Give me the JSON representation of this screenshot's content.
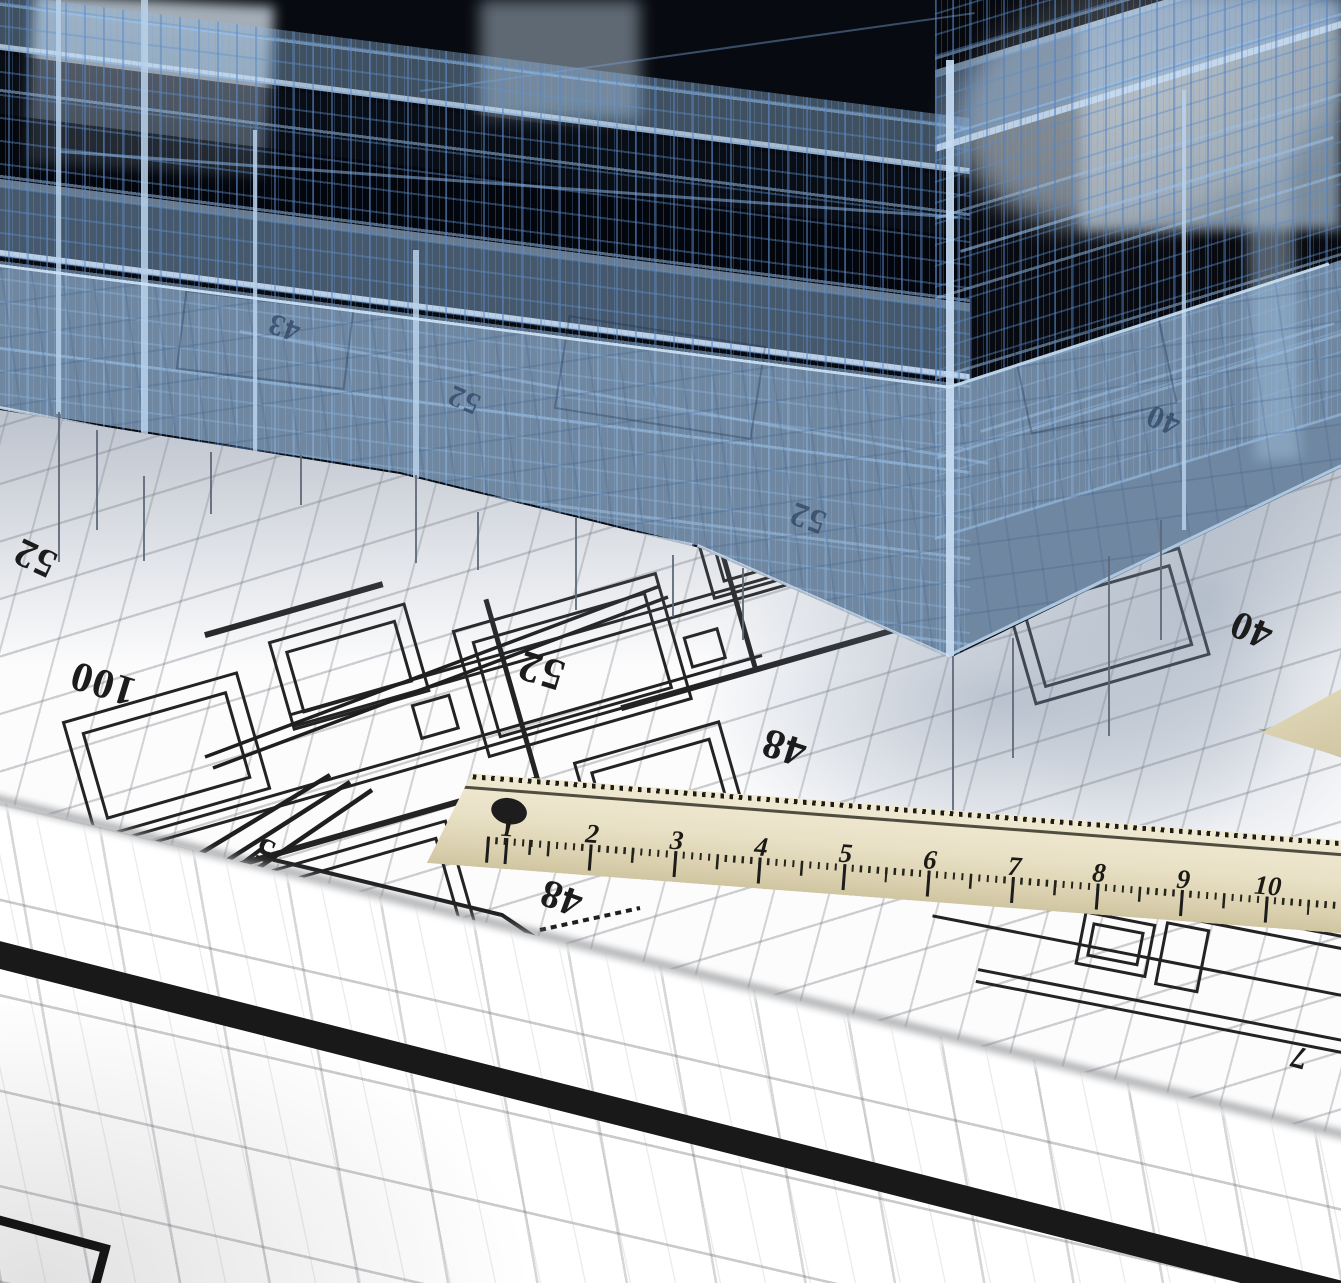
{
  "scene_label": "3D wireframe building model standing on architectural blueprints with a wooden ruler",
  "ruler": {
    "numbers": [
      "1",
      "2",
      "3",
      "4",
      "5",
      "6",
      "7",
      "8",
      "9",
      "10"
    ]
  },
  "plan": {
    "dimension_numbers": [
      {
        "value": "52"
      },
      {
        "value": "100"
      },
      {
        "value": "52"
      },
      {
        "value": "48"
      },
      {
        "value": "40"
      },
      {
        "value": "5"
      },
      {
        "value": "48"
      },
      {
        "value": "7"
      }
    ]
  },
  "building": {
    "ghost_numbers": [
      {
        "value": "43"
      },
      {
        "value": "52"
      },
      {
        "value": "52"
      },
      {
        "value": "40"
      }
    ]
  },
  "colors": {
    "wireframe_blue": "#4d7fba",
    "panel_blue": "#9dbede",
    "void_dark": "#070a10",
    "sheet_white": "#fcfcfd",
    "grid_gray": "#b9babf",
    "plan_line": "#232323",
    "ruler_cream": "#e9e1c6",
    "ruler_marking": "#1d1a14",
    "border_band_black": "#191919"
  }
}
